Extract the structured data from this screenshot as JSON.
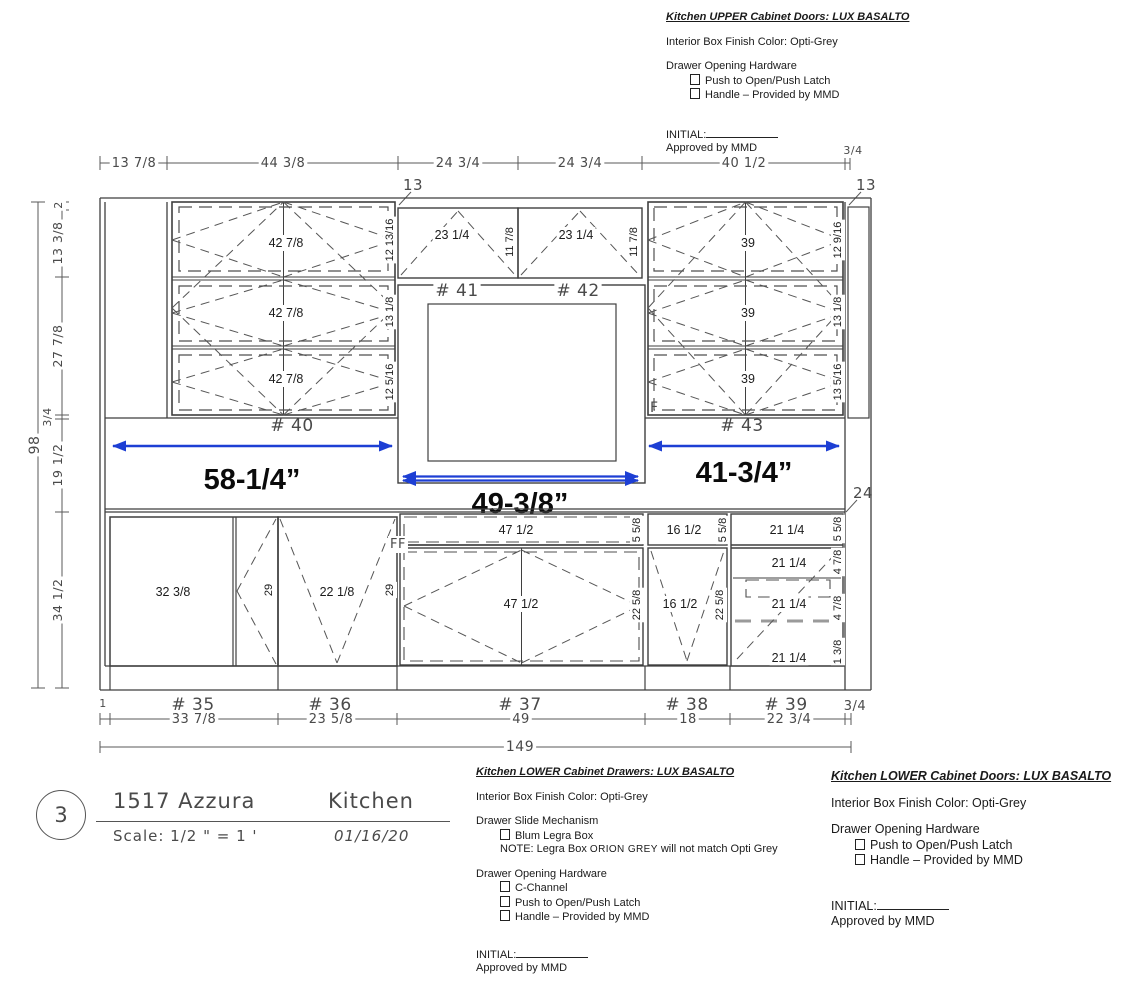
{
  "colors": {
    "line": "#3f3f3f",
    "blue_accent": "#1d3fd4"
  },
  "specs": {
    "upper_doors": {
      "title": "Kitchen UPPER Cabinet Doors: LUX BASALTO",
      "finish": "Interior Box Finish Color: Opti-Grey",
      "hardware_heading": "Drawer Opening Hardware",
      "hardware_options": [
        "Push to Open/Push Latch",
        "Handle – Provided by MMD"
      ],
      "initial_label": "INITIAL:",
      "approved": "Approved by MMD"
    },
    "lower_drawers": {
      "title": "Kitchen LOWER Cabinet Drawers: LUX BASALTO",
      "finish": "Interior Box Finish Color: Opti-Grey",
      "slide_heading": "Drawer Slide Mechanism",
      "slide_option": "Blum Legra Box",
      "note": {
        "p1": "NOTE: Legra Box",
        "p2": "ORION GREY",
        "p3": "will not match Opti Grey"
      },
      "hardware_heading": "Drawer Opening Hardware",
      "hardware_options": [
        "C-Channel",
        "Push to Open/Push Latch",
        "Handle – Provided by MMD"
      ],
      "initial_label": "INITIAL:",
      "approved": "Approved by MMD"
    },
    "lower_doors": {
      "title": "Kitchen LOWER Cabinet Doors: LUX BASALTO",
      "finish": "Interior Box Finish Color: Opti-Grey",
      "hardware_heading": "Drawer Opening Hardware",
      "hardware_options": [
        "Push to Open/Push Latch",
        "Handle – Provided by MMD"
      ],
      "initial_label": "INITIAL:",
      "approved": "Approved by MMD"
    }
  },
  "title_block": {
    "sheet_number": "3",
    "project": "1517 Azzura",
    "room": "Kitchen",
    "scale": "Scale: 1/2 \" = 1 '",
    "date": "01/16/20"
  },
  "drawing": {
    "top_dims": [
      "13 7/8",
      "44 3/8",
      "24 3/4",
      "24 3/4",
      "40 1/2",
      "3/4"
    ],
    "depth_13_left": "13",
    "depth_13_right": "13",
    "left": {
      "overall": "98",
      "s0": "2",
      "s1": "13 3/8",
      "s2": "27 7/8",
      "s3": "3/4",
      "s4": "19 1/2",
      "s5": "34 1/2"
    },
    "right_24": "24",
    "c40": {
      "label": "# 40",
      "w0": "42 7/8",
      "w1": "42 7/8",
      "w2": "42 7/8",
      "h0": "12 13/16",
      "h1": "13 1/8",
      "h2": "12 5/16"
    },
    "c41": {
      "label": "# 41",
      "w": "23 1/4",
      "h": "11 7/8"
    },
    "c42": {
      "label": "# 42",
      "w": "23 1/4",
      "h": "11 7/8"
    },
    "c43": {
      "label": "# 43",
      "w0": "39",
      "w1": "39",
      "w2": "39",
      "h0": "12 9/16",
      "h1": "13 1/8",
      "h2": "13 5/16",
      "f": "F"
    },
    "c35": {
      "label": "# 35",
      "panel": "32 3/8",
      "h": "29",
      "bottom": "33 7/8"
    },
    "c36": {
      "label": "# 36",
      "w": "22 1/8",
      "h": "29",
      "bottom": "23 5/8"
    },
    "c37": {
      "label": "# 37",
      "ff": "FF",
      "d0": "47 1/2",
      "d0h": "5 5/8",
      "d1": "47 1/2",
      "d1h": "22 5/8",
      "bottom": "49"
    },
    "c38": {
      "label": "# 38",
      "d0": "16 1/2",
      "d0h": "5 5/8",
      "d1": "16 1/2",
      "d1h": "22 5/8",
      "bottom": "18"
    },
    "c39": {
      "label": "# 39",
      "d0": "21 1/4",
      "d0h": "5 5/8",
      "d1": "21 1/4",
      "d1h": "4 7/8",
      "d2": "21 1/4",
      "d2h": "4 7/8",
      "d3": "21 1/4",
      "d3h": "1 3/8",
      "bottom": "22 3/4"
    },
    "bottom_end_left": "1",
    "bottom_end_right": "3/4",
    "overall_width": "149",
    "blue": {
      "left": "58-1/4”",
      "center": "49-3/8”",
      "right": "41-3/4”"
    }
  }
}
